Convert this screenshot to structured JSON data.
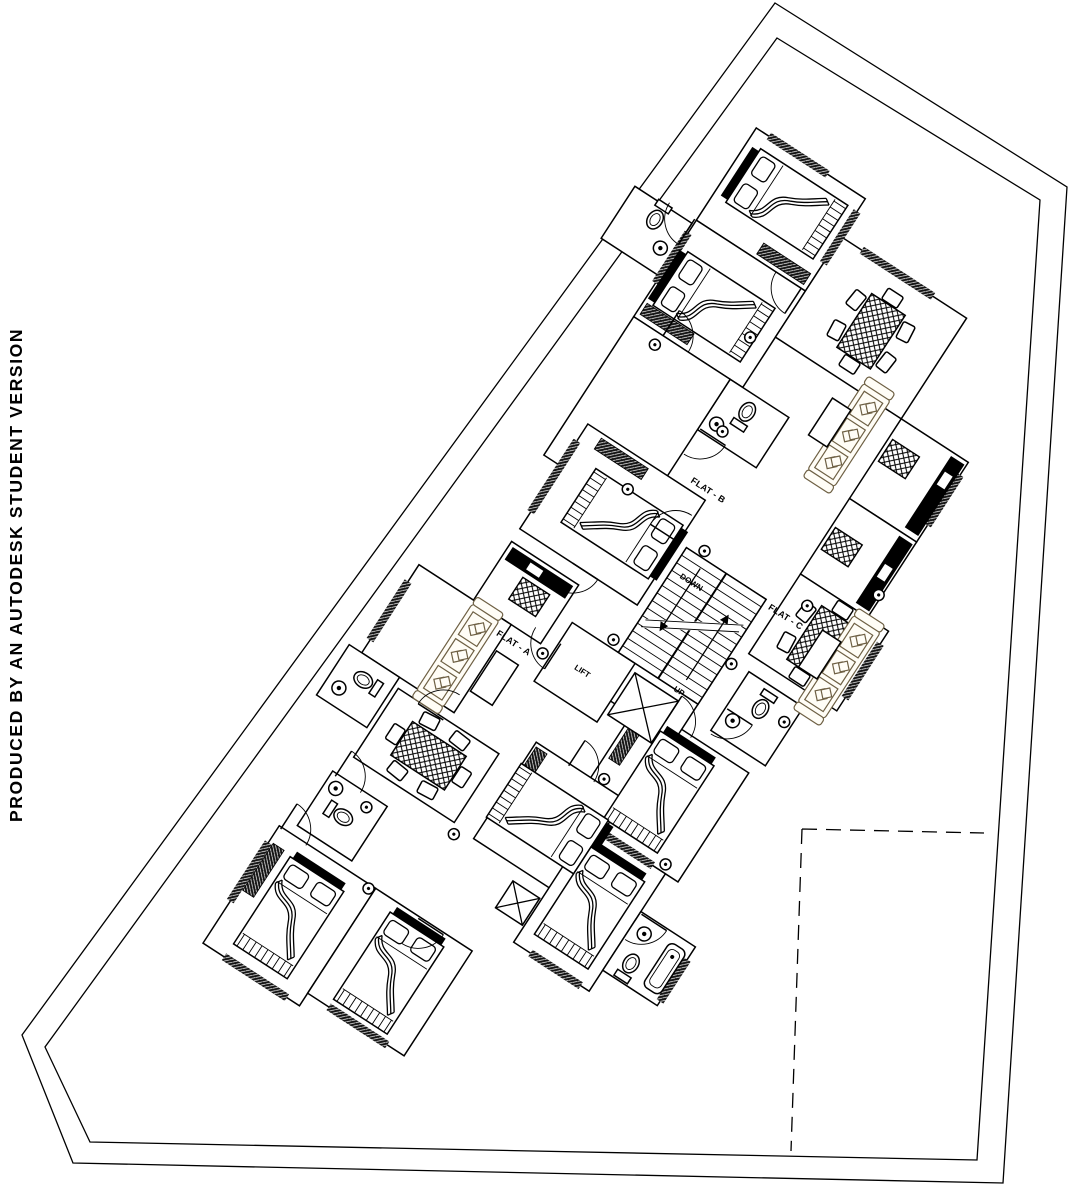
{
  "watermark": "PRODUCED BY AN AUTODESK STUDENT VERSION",
  "labels": {
    "flat_a": "FLAT - A",
    "flat_b": "FLAT - B",
    "flat_c": "FLAT - C",
    "stair_down": "DOWN",
    "stair_up": "UP",
    "lift": "LIFT"
  },
  "colors": {
    "ink": "#000000",
    "paper": "#ffffff",
    "furniture_accent": "#6e6044"
  }
}
